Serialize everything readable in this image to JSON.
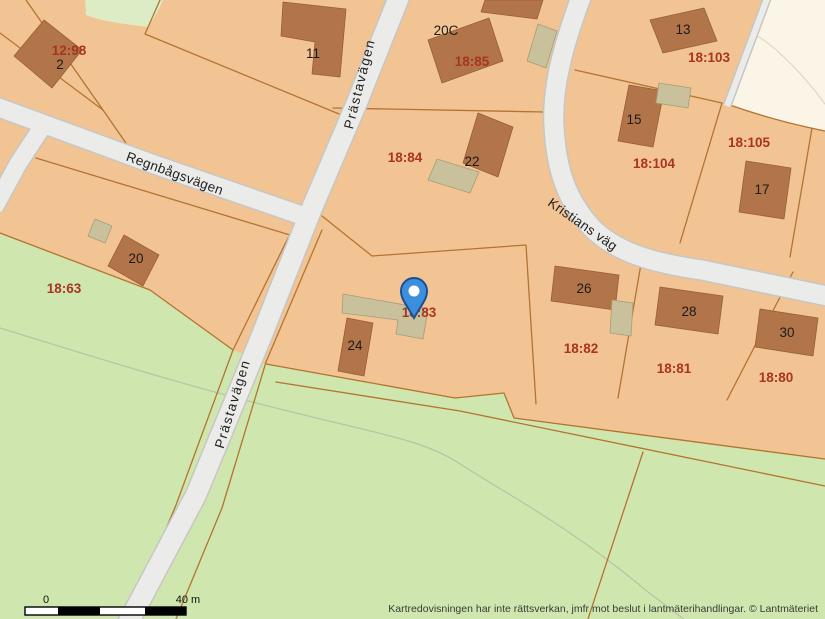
{
  "map": {
    "streets": {
      "prastavagen": "Prästavägen",
      "regnbagsvagen": "Regnbågsvägen",
      "kristians_vag": "Kristians väg"
    },
    "parcels": {
      "p12_98": "12:98",
      "p18_63": "18:63",
      "p18_85": "18:85",
      "p18_84": "18:84",
      "p18_103": "18:103",
      "p18_104": "18:104",
      "p18_105": "18:105",
      "p18_83": "18:83",
      "p18_82": "18:82",
      "p18_81": "18:81",
      "p18_80": "18:80"
    },
    "buildings": {
      "b2": "2",
      "b11": "11",
      "b20c": "20C",
      "b13": "13",
      "b15": "15",
      "b17": "17",
      "b22": "22",
      "b20": "20",
      "b24": "24",
      "b26": "26",
      "b28": "28",
      "b30": "30"
    },
    "colors": {
      "parcel_fill": "#f2c494",
      "building_fill": "#b27549",
      "outbuilding_fill": "#c9c09c",
      "green_fill": "#cfe7ae",
      "green_light_fill": "#dcedc6",
      "open_land_fill": "#faf5e6",
      "road_fill": "#ebebe9",
      "boundary_line": "#b3742f",
      "parcel_label_color": "#a93421",
      "building_label_color": "#1b1b1b",
      "marker_blue": "#3e8ede"
    }
  },
  "scalebar": {
    "start": "0",
    "end": "40 m"
  },
  "attribution": "Kartredovisningen har inte rättsverkan, jmfr mot beslut i lantmäterihandlingar. © Lantmäteriet"
}
